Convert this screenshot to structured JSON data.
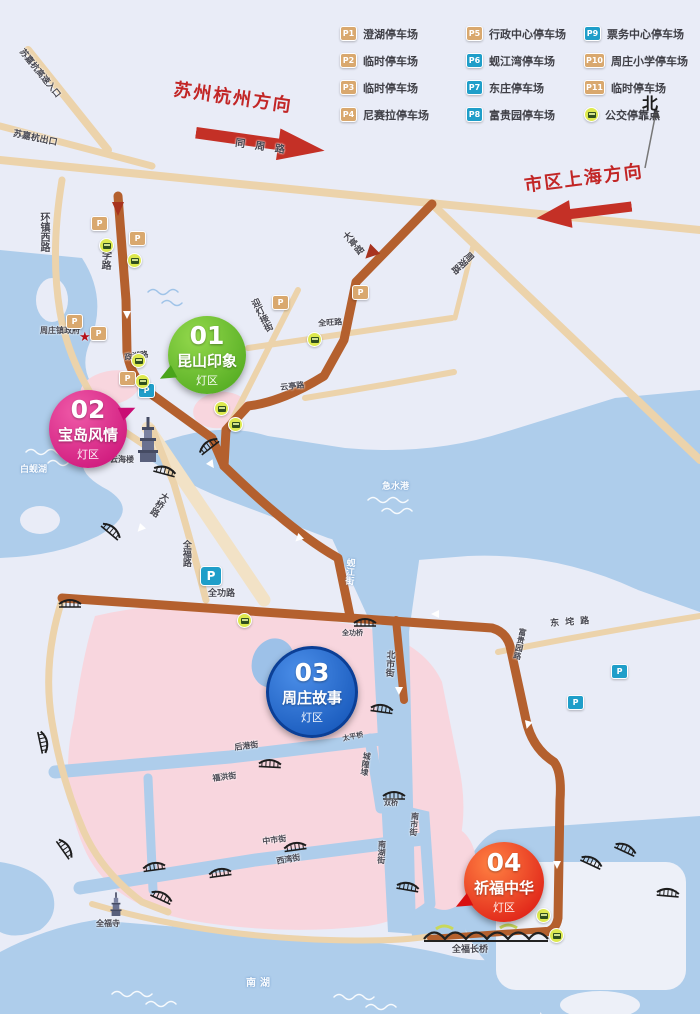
{
  "map": {
    "north": "北",
    "directions": {
      "suzhou_hangzhou": "苏州杭州方向",
      "shanghai": "市区上海方向"
    },
    "legend": {
      "items": [
        {
          "id": "P1",
          "label": "澄湖停车场",
          "color": "tan"
        },
        {
          "id": "P2",
          "label": "临时停车场",
          "color": "tan"
        },
        {
          "id": "P3",
          "label": "临时停车场",
          "color": "tan"
        },
        {
          "id": "P4",
          "label": "尼赛拉停车场",
          "color": "tan"
        },
        {
          "id": "P5",
          "label": "行政中心停车场",
          "color": "tan"
        },
        {
          "id": "P6",
          "label": "蚬江湾停车场",
          "color": "blue"
        },
        {
          "id": "P7",
          "label": "东庄停车场",
          "color": "blue"
        },
        {
          "id": "P8",
          "label": "富贵园停车场",
          "color": "blue"
        },
        {
          "id": "P9",
          "label": "票务中心停车场",
          "color": "blue"
        },
        {
          "id": "P10",
          "label": "周庄小学停车场",
          "color": "tan"
        },
        {
          "id": "P11",
          "label": "临时停车场",
          "color": "tan"
        },
        {
          "id": "BUS",
          "label": "公交停靠点",
          "color": "bus"
        }
      ]
    },
    "zones": [
      {
        "num": "01",
        "name": "昆山印象",
        "sub": "灯区",
        "x": 168,
        "y": 316,
        "d": 78,
        "c1": "#93d84c",
        "c2": "#49a41a",
        "tail": "bl"
      },
      {
        "num": "02",
        "name": "宝岛风情",
        "sub": "灯区",
        "x": 49,
        "y": 390,
        "d": 78,
        "c1": "#ef5aa8",
        "c2": "#c90c74",
        "tail": "tr"
      },
      {
        "num": "03",
        "name": "周庄故事",
        "sub": "灯区",
        "x": 266,
        "y": 646,
        "d": 86,
        "c1": "#4b8ee8",
        "c2": "#0f50b4",
        "tail": "none",
        "ring": "#0b3f96"
      },
      {
        "num": "04",
        "name": "祈福中华",
        "sub": "灯区",
        "x": 464,
        "y": 842,
        "d": 80,
        "c1": "#ff8142",
        "c2": "#d90f0f",
        "tail": "bl"
      }
    ],
    "labels": [
      {
        "t": "苏嘉杭高速入口",
        "x": 24,
        "y": 48,
        "rot": 51,
        "s": 8.5
      },
      {
        "t": "苏嘉杭出口",
        "x": 14,
        "y": 130,
        "rot": 12,
        "s": 9
      },
      {
        "t": "同周路",
        "x": 236,
        "y": 138,
        "rot": 8,
        "s": 10,
        "sp": 10
      },
      {
        "t": "环镇西路",
        "x": 38,
        "y": 212,
        "v": true,
        "s": 10
      },
      {
        "t": "大学路",
        "x": 100,
        "y": 240,
        "v": true,
        "rot": 2,
        "s": 10
      },
      {
        "t": "周庄镇政府",
        "x": 40,
        "y": 327,
        "s": 8
      },
      {
        "t": "迎灯接街",
        "x": 247,
        "y": 300,
        "v": true,
        "rot": -27,
        "s": 9
      },
      {
        "t": "大亭路",
        "x": 338,
        "y": 234,
        "v": true,
        "rot": -40,
        "s": 9
      },
      {
        "t": "周湖路",
        "x": 466,
        "y": 252,
        "v": true,
        "rot": 46,
        "s": 9
      },
      {
        "t": "全旺路",
        "x": 318,
        "y": 320,
        "rot": -4,
        "s": 8
      },
      {
        "t": "云亭路",
        "x": 280,
        "y": 384,
        "rot": -6,
        "s": 8
      },
      {
        "t": "政湖路",
        "x": 124,
        "y": 354,
        "rot": -8,
        "s": 8
      },
      {
        "t": "白蚬湖",
        "x": 20,
        "y": 466,
        "s": 9,
        "c": "w"
      },
      {
        "t": "云海楼",
        "x": 110,
        "y": 456,
        "s": 8
      },
      {
        "t": "急水港",
        "x": 382,
        "y": 483,
        "s": 9,
        "c": "w"
      },
      {
        "t": "大桥路",
        "x": 160,
        "y": 492,
        "v": true,
        "rot": 32,
        "s": 9
      },
      {
        "t": "全福路",
        "x": 180,
        "y": 540,
        "v": true,
        "s": 9
      },
      {
        "t": "全功路",
        "x": 208,
        "y": 590,
        "s": 9
      },
      {
        "t": "蚬江街",
        "x": 344,
        "y": 558,
        "v": true,
        "rot": 4,
        "s": 9,
        "c": "w"
      },
      {
        "t": "全功桥",
        "x": 342,
        "y": 630,
        "s": 7
      },
      {
        "t": "北市街",
        "x": 384,
        "y": 650,
        "v": true,
        "rot": 3,
        "s": 9
      },
      {
        "t": "东垞路",
        "x": 550,
        "y": 620,
        "rot": -4,
        "s": 9,
        "sp": 6
      },
      {
        "t": "富贵园路",
        "x": 518,
        "y": 628,
        "v": true,
        "rot": 12,
        "s": 8
      },
      {
        "t": "后港街",
        "x": 234,
        "y": 744,
        "rot": -7,
        "s": 8
      },
      {
        "t": "太平桥",
        "x": 342,
        "y": 736,
        "rot": -12,
        "s": 7
      },
      {
        "t": "城隍埭",
        "x": 362,
        "y": 752,
        "v": true,
        "rot": 8,
        "s": 8
      },
      {
        "t": "福洪街",
        "x": 212,
        "y": 775,
        "rot": -7,
        "s": 8
      },
      {
        "t": "双桥",
        "x": 384,
        "y": 800,
        "s": 7
      },
      {
        "t": "南市街",
        "x": 410,
        "y": 812,
        "v": true,
        "rot": 5,
        "s": 8
      },
      {
        "t": "南湖街",
        "x": 377,
        "y": 840,
        "v": true,
        "rot": 3,
        "s": 8
      },
      {
        "t": "中市街",
        "x": 262,
        "y": 838,
        "rot": -7,
        "s": 8
      },
      {
        "t": "西湾街",
        "x": 276,
        "y": 858,
        "rot": -10,
        "s": 8
      },
      {
        "t": "全福长桥",
        "x": 452,
        "y": 946,
        "s": 9
      },
      {
        "t": "全福寺",
        "x": 96,
        "y": 920,
        "s": 8
      },
      {
        "t": "南湖",
        "x": 246,
        "y": 978,
        "s": 10,
        "c": "w",
        "sp": 4
      }
    ],
    "parking": {
      "tan": [
        [
          91,
          216
        ],
        [
          129,
          231
        ],
        [
          66,
          314
        ],
        [
          90,
          326
        ],
        [
          119,
          371
        ],
        [
          272,
          295
        ],
        [
          352,
          285
        ]
      ],
      "blue": [
        [
          138,
          383
        ],
        [
          611,
          664
        ],
        [
          567,
          695
        ]
      ],
      "big_blue": [
        [
          200,
          566
        ]
      ]
    },
    "bus_stops": [
      [
        99,
        238
      ],
      [
        127,
        253
      ],
      [
        131,
        353
      ],
      [
        135,
        374
      ],
      [
        214,
        401
      ],
      [
        228,
        417
      ],
      [
        307,
        332
      ],
      [
        237,
        613
      ],
      [
        536,
        908
      ],
      [
        549,
        928
      ]
    ],
    "bridges": [
      [
        208,
        445,
        -38
      ],
      [
        165,
        470,
        15
      ],
      [
        112,
        530,
        40
      ],
      [
        70,
        603,
        0
      ],
      [
        365,
        622,
        0
      ],
      [
        270,
        763,
        3
      ],
      [
        382,
        708,
        8
      ],
      [
        394,
        795,
        0
      ],
      [
        295,
        846,
        -8
      ],
      [
        220,
        872,
        -8
      ],
      [
        154,
        866,
        -8
      ],
      [
        162,
        896,
        25
      ],
      [
        408,
        886,
        10
      ],
      [
        592,
        861,
        25
      ],
      [
        626,
        848,
        25
      ],
      [
        668,
        892,
        5
      ],
      [
        44,
        742,
        78
      ],
      [
        66,
        848,
        55
      ]
    ],
    "landmarks": {
      "gov_star": {
        "x": 79,
        "y": 331
      }
    },
    "colors": {
      "water": "#aecdeb",
      "land": "#e9ecf7",
      "pink_zone": "#f8d6de",
      "road": "#ecd3ab",
      "route": "#b4602e",
      "arrow_red": "#c43026",
      "legend_tan": "#d9a86e",
      "legend_blue": "#1f9ec9",
      "bus": "#dde94f",
      "zone_green": "#49a41a",
      "zone_magenta": "#c90c74",
      "zone_blue": "#0f50b4",
      "zone_red": "#d90f0f"
    }
  }
}
